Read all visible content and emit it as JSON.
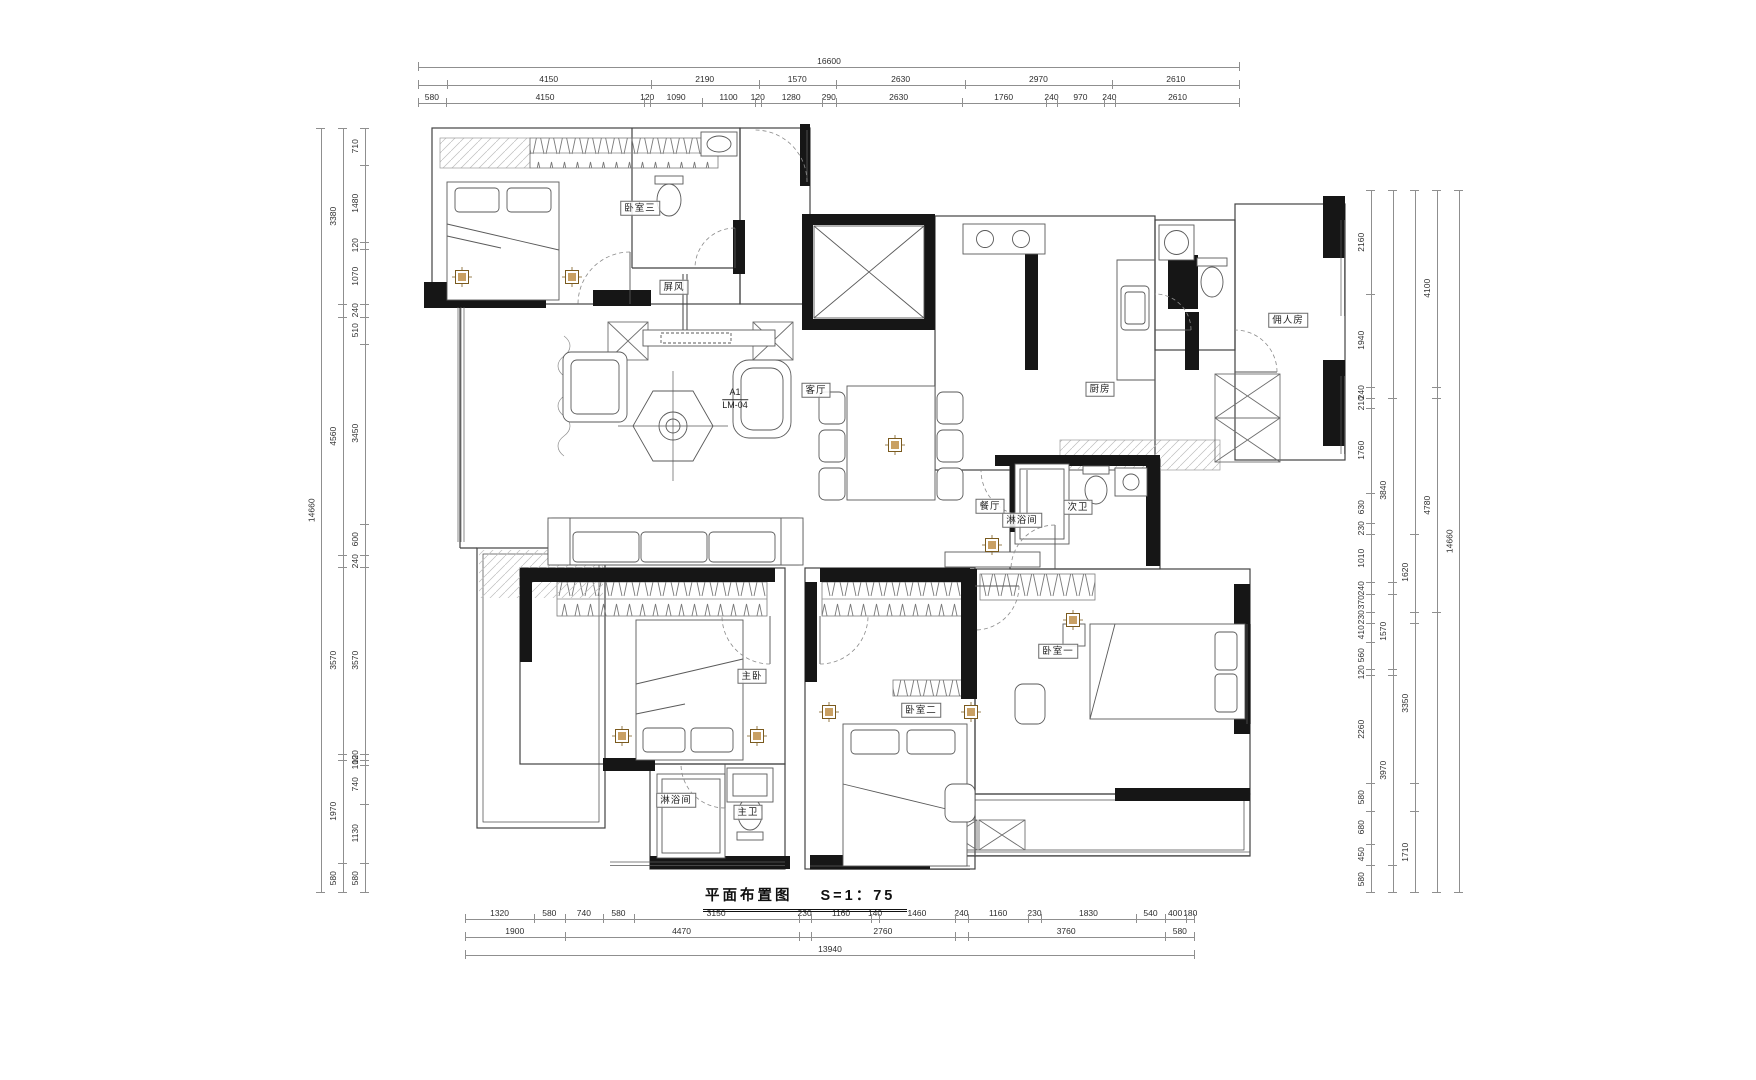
{
  "title": {
    "text": "平面布置图",
    "scale": "S=1：75"
  },
  "plan": {
    "marker": {
      "line1": "A1",
      "line2": "LM-04"
    },
    "room_labels": [
      {
        "id": "bedroom3",
        "text": "卧室三",
        "x": 640,
        "y": 208,
        "boxed": true
      },
      {
        "id": "screen",
        "text": "屏风",
        "x": 674,
        "y": 287,
        "boxed": true
      },
      {
        "id": "living",
        "text": "客厅",
        "x": 816,
        "y": 390,
        "boxed": true
      },
      {
        "id": "dining",
        "text": "餐厅",
        "x": 990,
        "y": 506,
        "boxed": true
      },
      {
        "id": "kitchen",
        "text": "厨房",
        "x": 1100,
        "y": 389,
        "boxed": true
      },
      {
        "id": "maid",
        "text": "佣人房",
        "x": 1288,
        "y": 320,
        "boxed": true
      },
      {
        "id": "shower-mid",
        "text": "淋浴间",
        "x": 1022,
        "y": 520,
        "boxed": true
      },
      {
        "id": "bath-second",
        "text": "次卫",
        "x": 1078,
        "y": 507,
        "boxed": true
      },
      {
        "id": "master",
        "text": "主卧",
        "x": 752,
        "y": 676,
        "boxed": true
      },
      {
        "id": "bedroom1",
        "text": "卧室一",
        "x": 1058,
        "y": 651,
        "boxed": true
      },
      {
        "id": "bedroom2",
        "text": "卧室二",
        "x": 921,
        "y": 710,
        "boxed": true
      },
      {
        "id": "shower-master",
        "text": "淋浴间",
        "x": 676,
        "y": 800,
        "boxed": true
      },
      {
        "id": "bath-master",
        "text": "主卫",
        "x": 748,
        "y": 812,
        "boxed": true
      }
    ]
  },
  "dimensions": {
    "top": [
      {
        "segs": [
          {
            "v": 16600,
            "t": "16600"
          }
        ]
      },
      {
        "segs": [
          {
            "v": 580,
            "t": ""
          },
          {
            "v": 4150,
            "t": "4150"
          },
          {
            "v": 2190,
            "t": "2190"
          },
          {
            "v": 1570,
            "t": "1570"
          },
          {
            "v": 2630,
            "t": "2630"
          },
          {
            "v": 2970,
            "t": "2970"
          },
          {
            "v": 2610,
            "t": "2610"
          }
        ]
      },
      {
        "segs": [
          {
            "v": 580,
            "t": "580"
          },
          {
            "v": 4150,
            "t": "4150"
          },
          {
            "v": 120,
            "t": "120"
          },
          {
            "v": 1090,
            "t": "1090"
          },
          {
            "v": 1100,
            "t": "1100"
          },
          {
            "v": 120,
            "t": "120"
          },
          {
            "v": 1280,
            "t": "1280"
          },
          {
            "v": 290,
            "t": "290"
          },
          {
            "v": 2630,
            "t": "2630"
          },
          {
            "v": 1760,
            "t": "1760"
          },
          {
            "v": 240,
            "t": "240"
          },
          {
            "v": 970,
            "t": "970"
          },
          {
            "v": 240,
            "t": "240"
          },
          {
            "v": 2610,
            "t": "2610"
          }
        ]
      }
    ],
    "bottom": [
      {
        "segs": [
          {
            "v": 1320,
            "t": "1320"
          },
          {
            "v": 580,
            "t": "580"
          },
          {
            "v": 740,
            "t": "740"
          },
          {
            "v": 580,
            "t": "580"
          },
          {
            "v": 3150,
            "t": "3150"
          },
          {
            "v": 230,
            "t": "230"
          },
          {
            "v": 1160,
            "t": "1160"
          },
          {
            "v": 140,
            "t": "140"
          },
          {
            "v": 1460,
            "t": "1460"
          },
          {
            "v": 240,
            "t": "240"
          },
          {
            "v": 1160,
            "t": "1160"
          },
          {
            "v": 230,
            "t": "230"
          },
          {
            "v": 1830,
            "t": "1830"
          },
          {
            "v": 540,
            "t": "540"
          },
          {
            "v": 400,
            "t": "400"
          },
          {
            "v": 180,
            "t": "180"
          }
        ]
      },
      {
        "segs": [
          {
            "v": 1900,
            "t": "1900"
          },
          {
            "v": 4470,
            "t": "4470"
          },
          {
            "v": 230,
            "t": ""
          },
          {
            "v": 2760,
            "t": "2760"
          },
          {
            "v": 240,
            "t": ""
          },
          {
            "v": 3760,
            "t": "3760"
          },
          {
            "v": 580,
            "t": "580"
          }
        ]
      },
      {
        "segs": [
          {
            "v": 13940,
            "t": "13940"
          }
        ]
      }
    ],
    "left": [
      {
        "segs": [
          {
            "v": 14660,
            "t": "14660"
          }
        ]
      },
      {
        "segs": [
          {
            "v": 3380,
            "t": "3380"
          },
          {
            "v": 240,
            "t": ""
          },
          {
            "v": 4560,
            "t": "4560"
          },
          {
            "v": 240,
            "t": ""
          },
          {
            "v": 3570,
            "t": "3570"
          },
          {
            "v": 120,
            "t": ""
          },
          {
            "v": 1970,
            "t": "1970"
          },
          {
            "v": 580,
            "t": "580"
          }
        ]
      },
      {
        "segs": [
          {
            "v": 710,
            "t": "710"
          },
          {
            "v": 1480,
            "t": "1480"
          },
          {
            "v": 120,
            "t": "120"
          },
          {
            "v": 1070,
            "t": "1070"
          },
          {
            "v": 240,
            "t": "240"
          },
          {
            "v": 510,
            "t": "510"
          },
          {
            "v": 3450,
            "t": "3450"
          },
          {
            "v": 600,
            "t": "600"
          },
          {
            "v": 240,
            "t": "240"
          },
          {
            "v": 3570,
            "t": "3570"
          },
          {
            "v": 120,
            "t": "120"
          },
          {
            "v": 100,
            "t": "100"
          },
          {
            "v": 740,
            "t": "740"
          },
          {
            "v": 1130,
            "t": "1130"
          },
          {
            "v": 580,
            "t": "580"
          }
        ]
      }
    ],
    "right": [
      {
        "segs": [
          {
            "v": 2160,
            "t": "2160"
          },
          {
            "v": 1940,
            "t": "1940"
          },
          {
            "v": 240,
            "t": "240"
          },
          {
            "v": 210,
            "t": "210"
          },
          {
            "v": 1760,
            "t": "1760"
          },
          {
            "v": 630,
            "t": "630"
          },
          {
            "v": 230,
            "t": "230"
          },
          {
            "v": 1010,
            "t": "1010"
          },
          {
            "v": 240,
            "t": "240"
          },
          {
            "v": 370,
            "t": "370"
          },
          {
            "v": 230,
            "t": "230"
          },
          {
            "v": 410,
            "t": "410"
          },
          {
            "v": 560,
            "t": "560"
          },
          {
            "v": 120,
            "t": "120"
          },
          {
            "v": 2260,
            "t": "2260"
          },
          {
            "v": 580,
            "t": "580"
          },
          {
            "v": 680,
            "t": "680"
          },
          {
            "v": 450,
            "t": "450"
          },
          {
            "v": 580,
            "t": "580"
          }
        ]
      },
      {
        "segs": [
          {
            "v": 4340,
            "t": ""
          },
          {
            "v": 3840,
            "t": "3840"
          },
          {
            "v": 240,
            "t": ""
          },
          {
            "v": 1570,
            "t": "1570"
          },
          {
            "v": 120,
            "t": ""
          },
          {
            "v": 3970,
            "t": "3970"
          },
          {
            "v": 580,
            "t": ""
          }
        ]
      },
      {
        "segs": [
          {
            "v": 7170,
            "t": ""
          },
          {
            "v": 1620,
            "t": "1620"
          },
          {
            "v": 230,
            "t": ""
          },
          {
            "v": 3350,
            "t": "3350"
          },
          {
            "v": 580,
            "t": ""
          },
          {
            "v": 1710,
            "t": "1710"
          }
        ]
      },
      {
        "segs": [
          {
            "v": 4100,
            "t": "4100"
          },
          {
            "v": 240,
            "t": ""
          },
          {
            "v": 4450,
            "t": "4780"
          },
          {
            "v": 5870,
            "t": ""
          }
        ]
      },
      {
        "segs": [
          {
            "v": 14660,
            "t": "14660"
          }
        ]
      }
    ]
  },
  "colors": {
    "wall": "#161616",
    "line": "#424242",
    "furniture": "#5a5a5a",
    "dim_line": "#8f8f8f",
    "accent": "#c9a063"
  }
}
